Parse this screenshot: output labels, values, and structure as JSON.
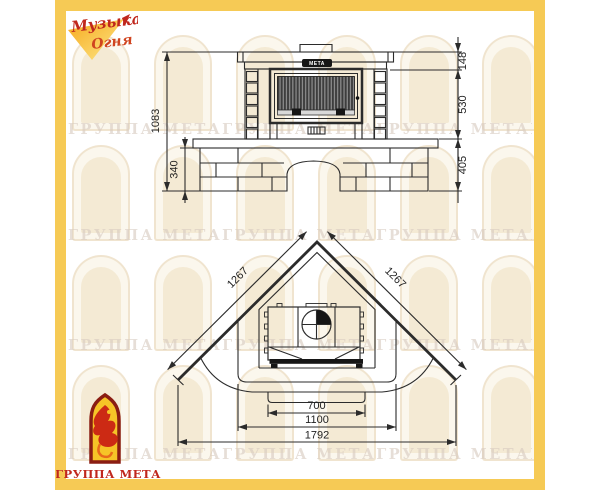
{
  "branding": {
    "top_logo_line1": "Музыка",
    "top_logo_line2": "Огня",
    "bottom_logo_label": "ГРУППА МЕТА",
    "watermark_text": "ГРУППА МЕТАГРУППА МЕТАГРУППА МЕТАГРУППА МЕТА",
    "colors": {
      "frame_yellow": "#f6ca55",
      "logo_red": "#c0271d",
      "arch_emblem_yellow": "#f6c427"
    }
  },
  "drawing": {
    "plaque_text": "МЕТА",
    "front_view": {
      "total_height": "1083",
      "hearth_height": "340",
      "crown_height": "148",
      "firebox_height": "530",
      "base_height": "405"
    },
    "plan_view": {
      "side_left": "1267",
      "side_right": "1267",
      "firebox_width": "700",
      "hearth_width": "1100",
      "total_width": "1792"
    }
  }
}
